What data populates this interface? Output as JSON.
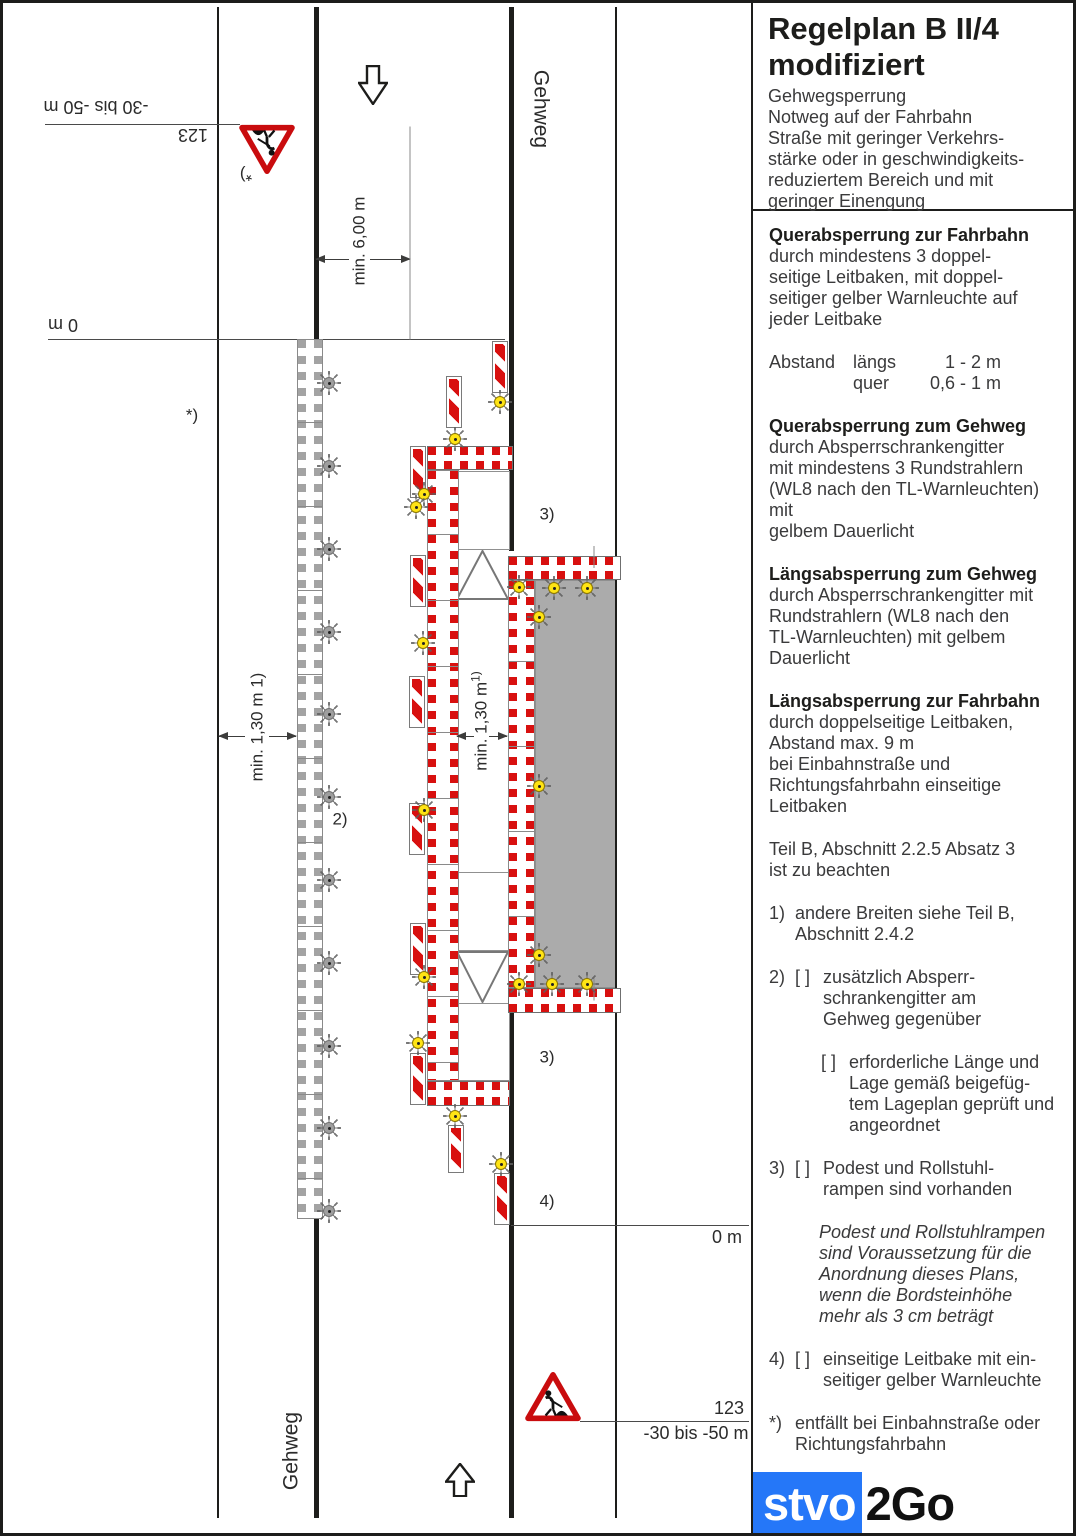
{
  "panel": {
    "title_line1": "Regelplan B II/4",
    "title_line2": "modifiziert",
    "subtitle_lines": [
      "Gehwegsperrung",
      "Notweg auf der Fahrbahn",
      "Straße mit geringer Verkehrs-",
      "stärke oder in geschwindigkeits-",
      "reduziertem Bereich und mit",
      "geringer Einengung"
    ],
    "sections": [
      {
        "type": "para",
        "heading": "Querabsperrung zur Fahrbahn",
        "lines": [
          "durch mindestens 3 doppel-",
          "seitige Leitbaken, mit doppel-",
          "seitiger gelber Warnleuchte auf",
          "jeder Leitbake"
        ]
      },
      {
        "type": "table",
        "rows": [
          [
            "Abstand",
            "längs",
            "1 - 2 m"
          ],
          [
            "",
            "quer",
            "0,6 - 1 m"
          ]
        ]
      },
      {
        "type": "para",
        "heading": "Querabsperrung zum Gehweg",
        "lines": [
          "durch Absperrschrankengitter",
          "mit mindestens 3 Rundstrahlern",
          "(WL8 nach den TL-Warnleuchten) mit",
          "gelbem Dauerlicht"
        ]
      },
      {
        "type": "para",
        "heading": "Längsabsperrung zum Gehweg",
        "lines": [
          "durch Absperrschrankengitter mit",
          "Rundstrahlern (WL8 nach den",
          "TL-Warnleuchten) mit gelbem",
          "Dauerlicht"
        ]
      },
      {
        "type": "para",
        "heading": "Längsabsperrung zur Fahrbahn",
        "lines": [
          "durch doppelseitige Leitbaken,",
          "Abstand max. 9 m",
          "bei Einbahnstraße und",
          "Richtungsfahrbahn einseitige",
          "Leitbaken"
        ]
      },
      {
        "type": "para",
        "lines": [
          "Teil B, Abschnitt 2.2.5 Absatz 3",
          "ist zu beachten"
        ]
      },
      {
        "type": "item",
        "marker": "1)",
        "lines": [
          "andere Breiten siehe Teil B,",
          "Abschnitt 2.4.2"
        ]
      },
      {
        "type": "item",
        "marker": "2)",
        "checkbox": "[ ]",
        "lines": [
          "zusätzlich Absperr-",
          "schrankengitter am",
          "Gehweg gegenüber"
        ]
      },
      {
        "type": "item",
        "marker": "",
        "checkbox": "[ ]",
        "indent": 1,
        "lines": [
          "erforderliche Länge und",
          "Lage gemäß beigefüg-",
          "tem Lageplan geprüft und",
          "angeordnet"
        ]
      },
      {
        "type": "item",
        "marker": "3)",
        "checkbox": "[ ]",
        "lines": [
          "Podest und Rollstuhl-",
          "rampen sind vorhanden"
        ]
      },
      {
        "type": "para",
        "style": "italic",
        "indent": 2,
        "lines": [
          "Podest und Rollstuhlrampen",
          "sind Voraussetzung für die",
          "Anordnung dieses Plans,",
          "wenn die Bordsteinhöhe",
          "mehr als 3 cm beträgt"
        ]
      },
      {
        "type": "item",
        "marker": "4)",
        "checkbox": "[ ]",
        "lines": [
          "einseitige Leitbake mit ein-",
          "seitiger gelber Warnleuchte"
        ]
      },
      {
        "type": "item",
        "marker": "*)",
        "lines": [
          "entfällt bei Einbahnstraße oder",
          "Richtungsfahrbahn"
        ]
      }
    ],
    "logo": {
      "text_blue": "stvo",
      "text_black": "2Go",
      "blue_color": "#2577f8"
    }
  },
  "diagram": {
    "colors": {
      "red": "#d8100f",
      "sign_red": "#c90c0e",
      "yellow": "#ffe414",
      "gray_fill": "#ababab"
    },
    "vlines": [
      {
        "name": "road-edge-left-line",
        "x": 214,
        "y1": 4,
        "y2": 1515,
        "w": 2
      },
      {
        "name": "curb-left-upper-line",
        "x": 311,
        "y1": 4,
        "y2": 337,
        "w": 5
      },
      {
        "name": "curb-left-lower-line",
        "x": 311,
        "y1": 1216,
        "y2": 1515,
        "w": 5
      },
      {
        "name": "curb-right-upper-line",
        "x": 506,
        "y1": 4,
        "y2": 548,
        "w": 5
      },
      {
        "name": "curb-right-lower-line",
        "x": 506,
        "y1": 1010,
        "y2": 1515,
        "w": 5
      },
      {
        "name": "road-edge-right-line",
        "x": 612,
        "y1": 4,
        "y2": 1515,
        "w": 2
      },
      {
        "name": "dimension-extension-line",
        "x": 407,
        "y1": 230,
        "y2": 443,
        "w": 1,
        "light": true
      },
      {
        "name": "barrier-panel-divider-top",
        "x": 591,
        "y1": 554,
        "y2": 576,
        "w": 1,
        "light": true
      },
      {
        "name": "barrier-panel-divider-bottom",
        "x": 591,
        "y1": 986,
        "y2": 1009,
        "w": 1,
        "light": true
      }
    ],
    "hlines": [
      {
        "name": "approach-dim-line-top",
        "x1": 42,
        "x2": 237,
        "y": 121
      },
      {
        "name": "station-zero-line-top",
        "x1": 45,
        "x2": 502,
        "y": 336
      },
      {
        "name": "station-zero-line-bottom",
        "x1": 508,
        "x2": 746,
        "y": 1222
      },
      {
        "name": "approach-dim-line-bottom",
        "x1": 577,
        "x2": 746,
        "y": 1418
      }
    ],
    "dims": [
      {
        "name": "road-width-dim-left",
        "y": 256,
        "x1": 313,
        "x2": 346,
        "head": "left"
      },
      {
        "name": "road-width-dim-right",
        "y": 256,
        "x1": 367,
        "x2": 407,
        "head": "right"
      },
      {
        "name": "notweg-dim-outer-left",
        "y": 733,
        "x1": 216,
        "x2": 242,
        "head": "left"
      },
      {
        "name": "notweg-dim-outer-right",
        "y": 733,
        "x1": 266,
        "x2": 293,
        "head": "right"
      },
      {
        "name": "notweg-dim-inner-left",
        "y": 733,
        "x1": 454,
        "x2": 471,
        "head": "left"
      },
      {
        "name": "notweg-dim-inner-right",
        "y": 733,
        "x1": 486,
        "x2": 504,
        "head": "right"
      }
    ],
    "barriers_h": [
      {
        "name": "cross-barrier-sidewalk-top",
        "x": 424,
        "y": 443,
        "w": 86,
        "h": 24
      },
      {
        "name": "cross-barrier-sidewalk-bottom",
        "x": 424,
        "y": 1078,
        "w": 83,
        "h": 25
      },
      {
        "name": "workzone-barrier-top",
        "x": 505,
        "y": 553,
        "w": 113,
        "h": 24
      },
      {
        "name": "workzone-barrier-bottom",
        "x": 505,
        "y": 985,
        "w": 113,
        "h": 25
      }
    ],
    "ladders": [
      {
        "name": "longitudinal-barrier-roadside",
        "color": "red",
        "x": 424,
        "y": 467,
        "w": 32,
        "h": 611,
        "seps": [
          530,
          596,
          662,
          728,
          794,
          860,
          926,
          992,
          1058
        ]
      },
      {
        "name": "longitudinal-barrier-workzone",
        "color": "red",
        "x": 505,
        "y": 577,
        "w": 27,
        "h": 408,
        "seps": [
          657,
          742,
          827,
          912
        ]
      },
      {
        "name": "closed-sidewalk-barrier",
        "color": "gray",
        "x": 294,
        "y": 336,
        "w": 26,
        "h": 880,
        "seps": [
          418,
          502,
          586,
          670,
          754,
          838,
          922,
          1006,
          1090,
          1174
        ]
      }
    ],
    "gray_area": {
      "name": "work-area",
      "x": 532,
      "y": 577,
      "w": 81,
      "h": 408
    },
    "cells": [
      {
        "name": "ramp-cell-top",
        "x": 452,
        "y": 468,
        "w": 55,
        "h": 79
      },
      {
        "name": "ramp-cell-middle",
        "x": 452,
        "y": 869,
        "w": 55,
        "h": 79
      },
      {
        "name": "ramp-cell-bottom",
        "x": 452,
        "y": 1000,
        "w": 55,
        "h": 78
      }
    ],
    "ramps": [
      {
        "name": "ramp-triangle-up",
        "x": 453,
        "y": 547,
        "w": 53,
        "h": 50,
        "dir": "up"
      },
      {
        "name": "ramp-triangle-down",
        "x": 453,
        "y": 948,
        "w": 53,
        "h": 52,
        "dir": "down"
      }
    ],
    "bakes": [
      {
        "x": 489,
        "y": 338
      },
      {
        "x": 443,
        "y": 373
      },
      {
        "x": 407,
        "y": 443
      },
      {
        "x": 407,
        "y": 552
      },
      {
        "x": 406,
        "y": 673
      },
      {
        "x": 406,
        "y": 800
      },
      {
        "x": 407,
        "y": 920
      },
      {
        "x": 407,
        "y": 1050
      },
      {
        "x": 445,
        "y": 1122,
        "h": 48
      },
      {
        "x": 491,
        "y": 1170
      }
    ],
    "lights": [
      {
        "c": "yellow",
        "x": 497,
        "y": 399
      },
      {
        "c": "yellow",
        "x": 452,
        "y": 436
      },
      {
        "c": "yellow",
        "x": 421,
        "y": 491
      },
      {
        "c": "yellow",
        "x": 413,
        "y": 504
      },
      {
        "c": "yellow",
        "x": 420,
        "y": 640
      },
      {
        "c": "yellow",
        "x": 421,
        "y": 807
      },
      {
        "c": "yellow",
        "x": 421,
        "y": 974
      },
      {
        "c": "yellow",
        "x": 415,
        "y": 1040
      },
      {
        "c": "yellow",
        "x": 452,
        "y": 1113
      },
      {
        "c": "yellow",
        "x": 498,
        "y": 1161
      },
      {
        "c": "yellow",
        "x": 516,
        "y": 584
      },
      {
        "c": "yellow",
        "x": 551,
        "y": 585
      },
      {
        "c": "yellow",
        "x": 584,
        "y": 585
      },
      {
        "c": "yellow",
        "x": 536,
        "y": 614
      },
      {
        "c": "yellow",
        "x": 536,
        "y": 783
      },
      {
        "c": "yellow",
        "x": 536,
        "y": 952
      },
      {
        "c": "yellow",
        "x": 516,
        "y": 981
      },
      {
        "c": "yellow",
        "x": 549,
        "y": 981
      },
      {
        "c": "yellow",
        "x": 584,
        "y": 981
      },
      {
        "c": "gray",
        "x": 326,
        "y": 380
      },
      {
        "c": "gray",
        "x": 326,
        "y": 463
      },
      {
        "c": "gray",
        "x": 326,
        "y": 546
      },
      {
        "c": "gray",
        "x": 326,
        "y": 629
      },
      {
        "c": "gray",
        "x": 326,
        "y": 711
      },
      {
        "c": "gray",
        "x": 326,
        "y": 794
      },
      {
        "c": "gray",
        "x": 326,
        "y": 877
      },
      {
        "c": "gray",
        "x": 326,
        "y": 960
      },
      {
        "c": "gray",
        "x": 326,
        "y": 1043
      },
      {
        "c": "gray",
        "x": 326,
        "y": 1125
      },
      {
        "c": "gray",
        "x": 326,
        "y": 1208
      }
    ],
    "signs": [
      {
        "name": "construction-work-sign-123-inverted",
        "cx": 264,
        "cy": 146,
        "rot": 180
      },
      {
        "name": "construction-work-sign-123",
        "cx": 550,
        "cy": 1394,
        "rot": 0
      }
    ],
    "arrows": [
      {
        "name": "direction-arrow-down",
        "cx": 370,
        "cy": 82,
        "w": 30,
        "h": 40,
        "dir": "down"
      },
      {
        "name": "direction-arrow-up",
        "cx": 457,
        "cy": 1477,
        "w": 30,
        "h": 34,
        "dir": "up"
      }
    ],
    "labels": [
      {
        "name": "approach-distance-label-top",
        "text": "-30 bis -50 m",
        "cx": 93,
        "cy": 104,
        "rot": 180,
        "size": 18
      },
      {
        "name": "sign-number-label-top",
        "text": "123",
        "cx": 190,
        "cy": 132,
        "rot": 180,
        "size": 18
      },
      {
        "name": "footnote-star-at-sign",
        "text": "*)",
        "cx": 243,
        "cy": 172,
        "rot": 180,
        "size": 17
      },
      {
        "name": "station-zero-label-top",
        "text": "0 m",
        "cx": 60,
        "cy": 322,
        "rot": 180,
        "size": 18
      },
      {
        "name": "footnote-star-label",
        "text": "*)",
        "cx": 189,
        "cy": 412,
        "rot": 0,
        "size": 17
      },
      {
        "name": "road-width-dim-label",
        "text": "min. 6,00 m",
        "cx": 356,
        "cy": 238,
        "rot": -90,
        "size": 17
      },
      {
        "name": "notweg-width-dim-label-left",
        "text": "min. 1,30 m 1)",
        "cx": 254,
        "cy": 724,
        "rot": -90,
        "size": 17
      },
      {
        "name": "notweg-width-dim-label-right",
        "text": "min. 1,30 m",
        "sup": "1)",
        "cx": 477,
        "cy": 718,
        "rot": -90,
        "size": 17
      },
      {
        "name": "footnote-2-label",
        "text": "2)",
        "cx": 337,
        "cy": 816,
        "rot": 0,
        "size": 17
      },
      {
        "name": "footnote-3-label-top",
        "text": "3)",
        "cx": 544,
        "cy": 511,
        "rot": 0,
        "size": 17
      },
      {
        "name": "footnote-3-label-bottom",
        "text": "3)",
        "cx": 544,
        "cy": 1054,
        "rot": 0,
        "size": 17
      },
      {
        "name": "footnote-4-label",
        "text": "4)",
        "cx": 544,
        "cy": 1198,
        "rot": 0,
        "size": 17
      },
      {
        "name": "station-zero-label-bottom",
        "text": "0 m",
        "cx": 724,
        "cy": 1234,
        "rot": 0,
        "size": 18
      },
      {
        "name": "sign-number-label-bottom",
        "text": "123",
        "cx": 726,
        "cy": 1405,
        "rot": 0,
        "size": 18
      },
      {
        "name": "approach-distance-label-bottom",
        "text": "-30 bis -50 m",
        "cx": 693,
        "cy": 1430,
        "rot": 0,
        "size": 18
      },
      {
        "name": "sidewalk-label-top",
        "text": "Gehweg",
        "cx": 538,
        "cy": 106,
        "rot": 90,
        "size": 21
      },
      {
        "name": "sidewalk-label-bottom",
        "text": "Gehweg",
        "cx": 288,
        "cy": 1448,
        "rot": -90,
        "size": 21
      }
    ]
  }
}
